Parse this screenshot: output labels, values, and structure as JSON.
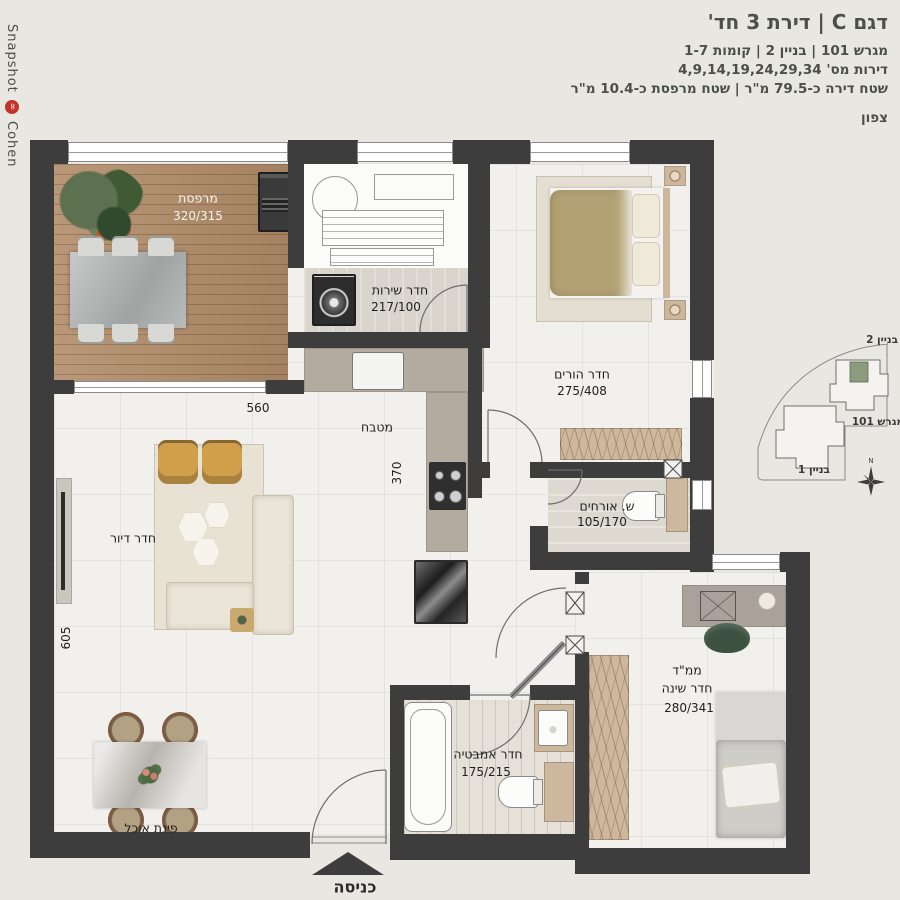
{
  "branding": {
    "studio_top": "Snapshot",
    "studio_bottom": "Cohen",
    "logo_symbol": "∞"
  },
  "header": {
    "title": "דגם C | דירת 3 חד'",
    "line_lot": "מגרש 101 | בניין 2 | קומות 1-7",
    "line_apartments": "דירות מס' 4,9,14,19,24,29,34",
    "line_areas": "שטח דירה כ-79.5 מ\"ר | שטח מרפסת כ-10.4 מ\"ר",
    "north_label": "צפון"
  },
  "site_map": {
    "building2_label": "בניין 2",
    "building1_label": "בניין 1",
    "lot_label": "מגרש 101",
    "north_letter": "N",
    "highlight_color": "#8a9b7e"
  },
  "rooms": {
    "balcony": {
      "name": "מרפסת",
      "dims": "320/315"
    },
    "service": {
      "name": "חדר שירות",
      "dims": "217/100"
    },
    "master": {
      "name": "חדר הורים",
      "dims": "275/408"
    },
    "kitchen": {
      "name": "מטבח"
    },
    "living": {
      "name": "חדר דיור"
    },
    "guest_wc": {
      "name": "ש. אורחים",
      "dims": "105/170"
    },
    "mamad": {
      "name": "ממ\"ד",
      "name2": "חדר שינה",
      "dims": "280/341"
    },
    "bathroom": {
      "name": "חדר אמבטיה",
      "dims": "175/215"
    },
    "dining": {
      "name": "פינת אוכל"
    },
    "entrance": {
      "name": "כניסה"
    }
  },
  "dimensions": {
    "living_width": "560",
    "kitchen_depth": "370",
    "living_height": "605"
  },
  "colors": {
    "wall": "#3d3d3d",
    "background": "#e9e7e1",
    "accent_title": "#4b5244",
    "logo_red": "#c2342b"
  }
}
